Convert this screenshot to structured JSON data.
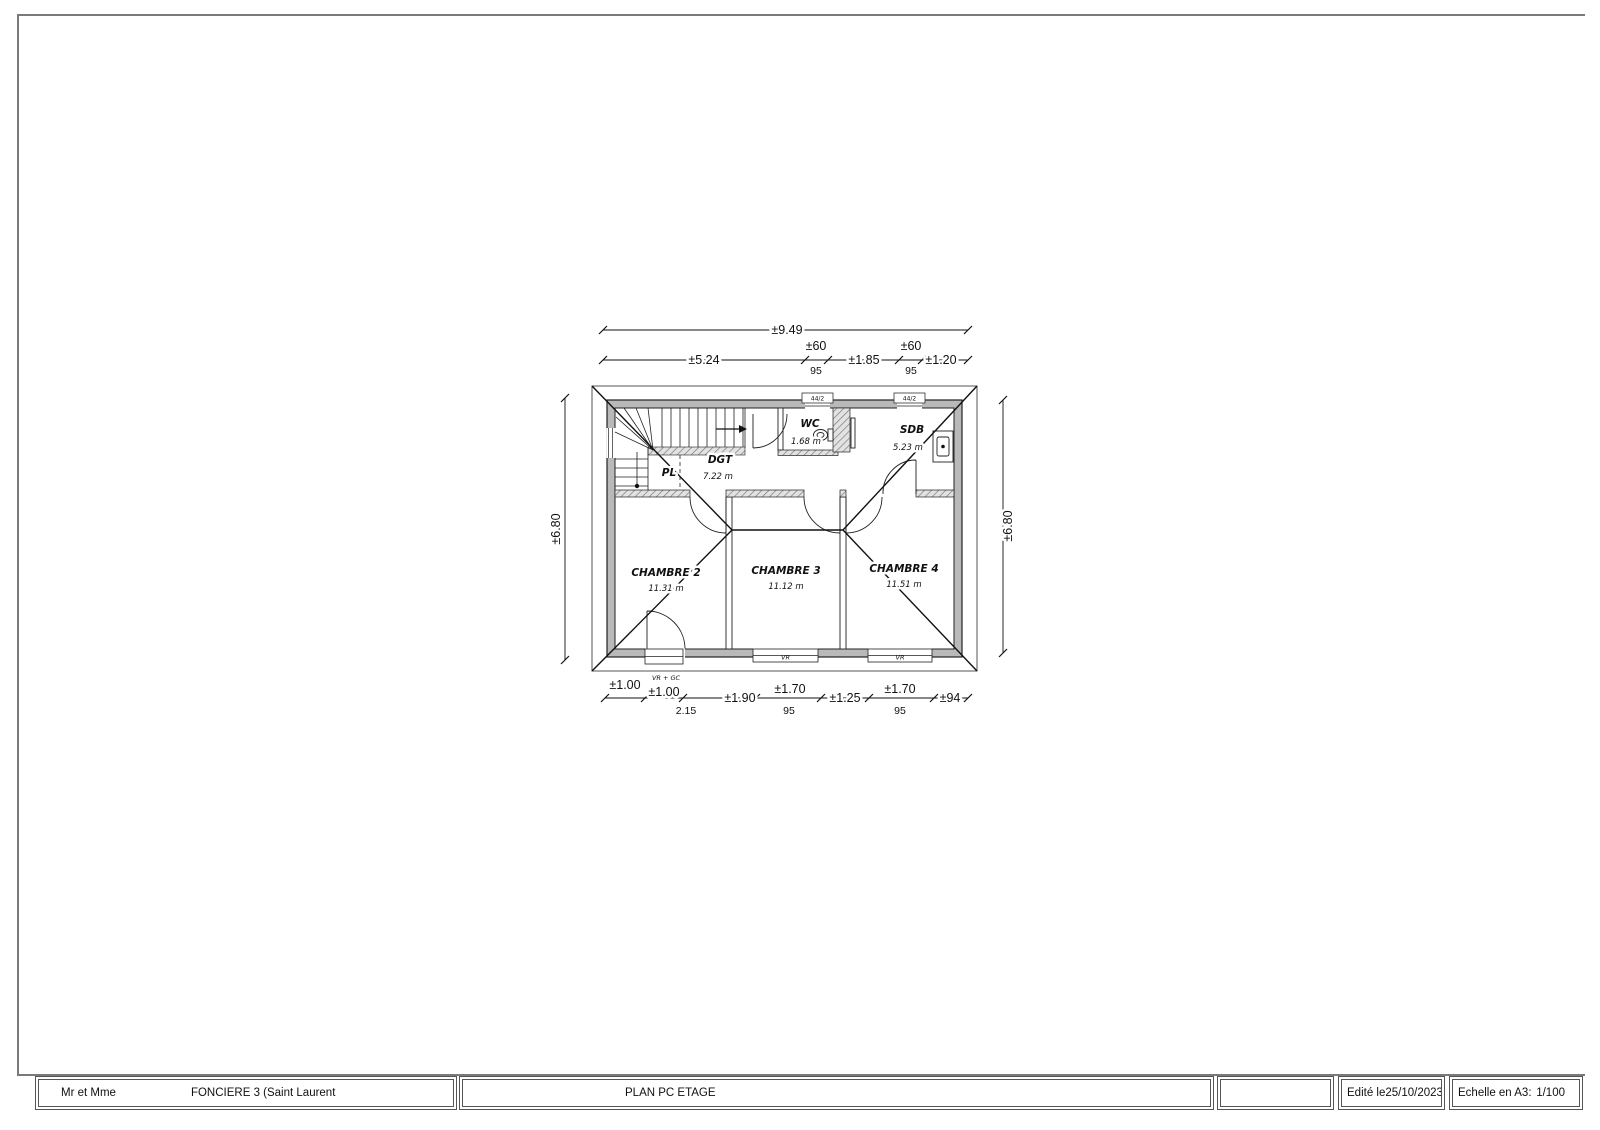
{
  "title_block": {
    "client": "Mr et Mme",
    "project": "FONCIERE 3 (Saint Laurent",
    "drawing_title": "PLAN PC ETAGE",
    "edited_label": "Edité le",
    "edited_date": "25/10/2023",
    "scale_label": "Echelle en A3:",
    "scale_value": "1/100"
  },
  "plan": {
    "rooms": {
      "chambre2": {
        "name": "CHAMBRE 2",
        "area": "11.31 m"
      },
      "chambre3": {
        "name": "CHAMBRE 3",
        "area": "11.12 m"
      },
      "chambre4": {
        "name": "CHAMBRE 4",
        "area": "11.51 m"
      },
      "wc": {
        "name": "WC",
        "area": "1.68 m"
      },
      "sdb": {
        "name": "SDB",
        "area": "5.23 m"
      },
      "dgt": {
        "name": "DGT",
        "area": "7.22 m"
      },
      "pl": {
        "name": "PL"
      }
    },
    "openings": {
      "top_window_1": "44/2",
      "top_window_2": "44/2",
      "bottom_window_1": "VR",
      "bottom_window_2": "VR",
      "bottom_door": "VR + GC"
    },
    "dims": {
      "top_total": "±9.49",
      "top_1": "±5.24",
      "top_2": "±60",
      "top_2_sub": "95",
      "top_3": "±1.85",
      "top_4": "±60",
      "top_4_sub": "95",
      "top_5": "±1.20",
      "left": "±6.80",
      "right": "±6.80",
      "bot_1": "±1.00",
      "bot_2": "±1.00",
      "bot_2_sub": "2.15",
      "bot_3": "±1.90",
      "bot_4": "±1.70",
      "bot_4_sub": "95",
      "bot_5": "±1.25",
      "bot_6": "±1.70",
      "bot_6_sub": "95",
      "bot_7": "±94"
    },
    "colors": {
      "wall_fill": "#b9b9b9",
      "line": "#1a1a1a"
    }
  }
}
